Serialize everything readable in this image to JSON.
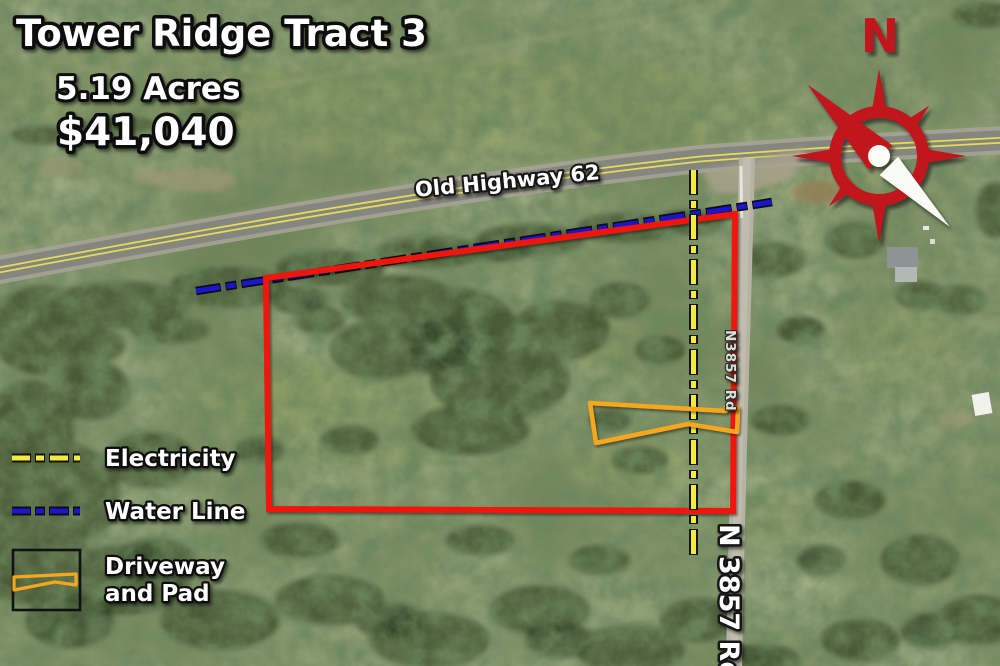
{
  "title": {
    "name": "Tower Ridge Tract 3",
    "acreage": "5.19 Acres",
    "price": "$41,040"
  },
  "map_labels": {
    "highway": "Old Highway 62",
    "road_small": "N3857 Rd",
    "road_large": "N 3857 Rd"
  },
  "compass": {
    "north": "N"
  },
  "legend": {
    "electricity": "Electricity",
    "water_line": "Water Line",
    "driveway_line1": "Driveway",
    "driveway_line2": "and Pad"
  },
  "colors": {
    "boundary_red": "#ee1408",
    "electricity_yellow": "#f3ec3e",
    "water_blue": "#1a16cf",
    "driveway_orange": "#f7a71c",
    "compass_red": "#c1121a"
  }
}
